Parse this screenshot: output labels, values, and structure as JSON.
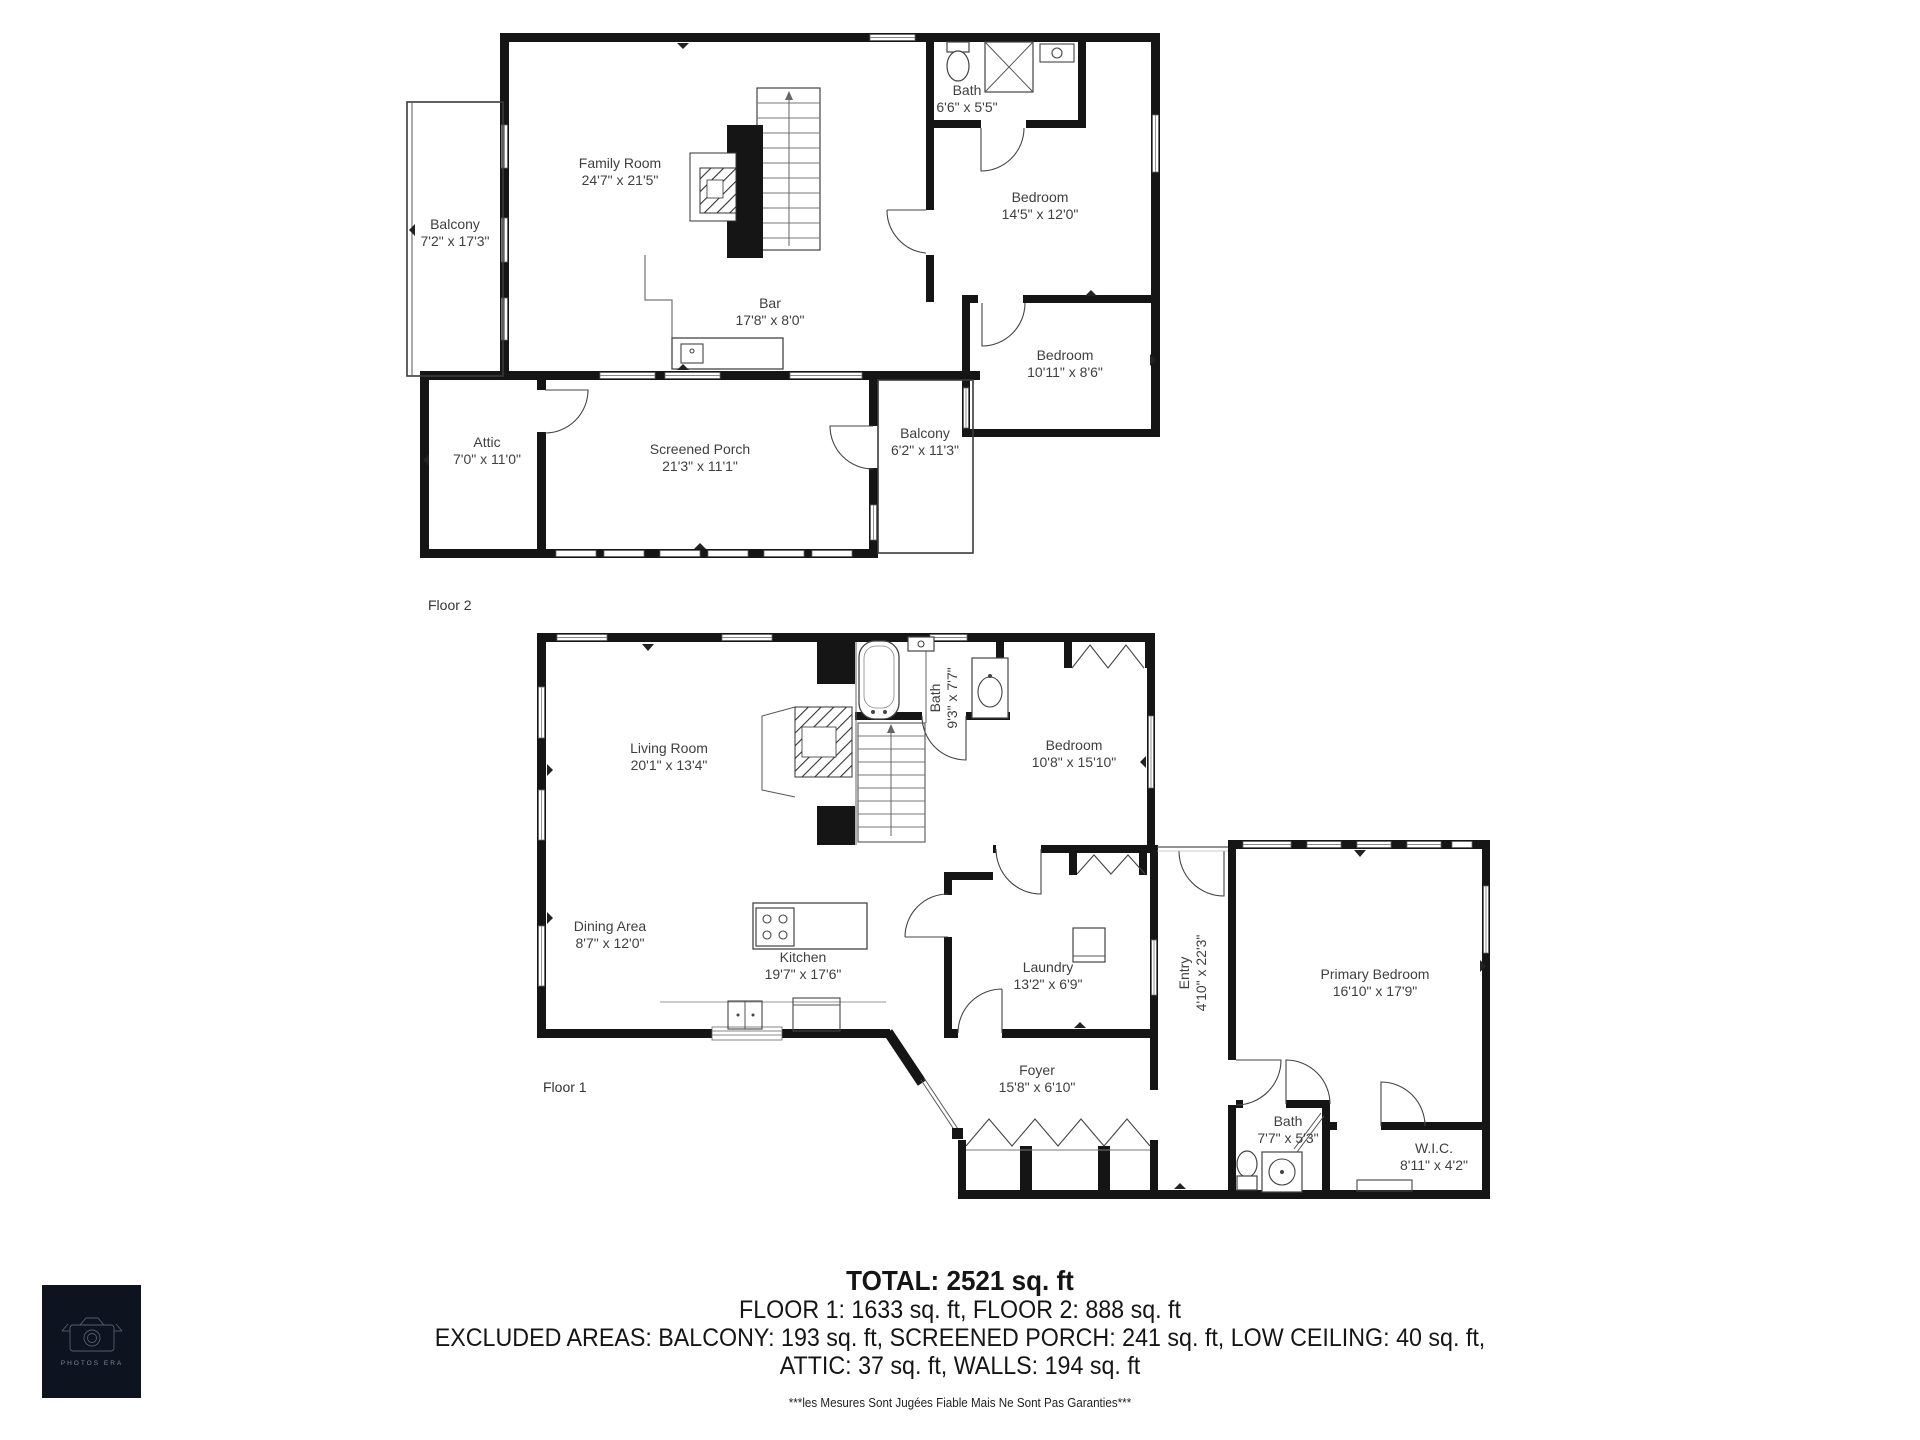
{
  "floor2": {
    "label": "Floor 2",
    "rooms": [
      {
        "id": "family-room",
        "name": "Family Room",
        "dims": "24'7\" x 21'5\""
      },
      {
        "id": "balcony-left",
        "name": "Balcony",
        "dims": "7'2\" x 17'3\""
      },
      {
        "id": "bath",
        "name": "Bath",
        "dims": "6'6\" x 5'5\""
      },
      {
        "id": "bedroom-1",
        "name": "Bedroom",
        "dims": "14'5\" x 12'0\""
      },
      {
        "id": "bar",
        "name": "Bar",
        "dims": "17'8\" x 8'0\""
      },
      {
        "id": "bedroom-2",
        "name": "Bedroom",
        "dims": "10'11\" x 8'6\""
      },
      {
        "id": "attic",
        "name": "Attic",
        "dims": "7'0\" x 11'0\""
      },
      {
        "id": "screened-porch",
        "name": "Screened Porch",
        "dims": "21'3\" x 11'1\""
      },
      {
        "id": "balcony-right",
        "name": "Balcony",
        "dims": "6'2\" x 11'3\""
      }
    ]
  },
  "floor1": {
    "label": "Floor 1",
    "rooms": [
      {
        "id": "living-room",
        "name": "Living Room",
        "dims": "20'1\" x 13'4\""
      },
      {
        "id": "bath-upper",
        "name": "Bath",
        "dims": "9'3\" x 7'7\""
      },
      {
        "id": "bedroom",
        "name": "Bedroom",
        "dims": "10'8\" x 15'10\""
      },
      {
        "id": "dining-area",
        "name": "Dining Area",
        "dims": "8'7\" x 12'0\""
      },
      {
        "id": "kitchen",
        "name": "Kitchen",
        "dims": "19'7\" x 17'6\""
      },
      {
        "id": "laundry",
        "name": "Laundry",
        "dims": "13'2\" x 6'9\""
      },
      {
        "id": "entry",
        "name": "Entry",
        "dims": "4'10\" x 22'3\""
      },
      {
        "id": "primary-bedroom",
        "name": "Primary Bedroom",
        "dims": "16'10\" x 17'9\""
      },
      {
        "id": "foyer",
        "name": "Foyer",
        "dims": "15'8\" x 6'10\""
      },
      {
        "id": "bath-lower",
        "name": "Bath",
        "dims": "7'7\" x 5'3\""
      },
      {
        "id": "wic",
        "name": "W.I.C.",
        "dims": "8'11\" x 4'2\""
      }
    ]
  },
  "summary": {
    "total": "TOTAL: 2521 sq. ft",
    "floors": "FLOOR 1: 1633 sq. ft, FLOOR 2: 888 sq. ft",
    "excluded_1": "EXCLUDED AREAS: BALCONY: 193 sq. ft, SCREENED PORCH: 241 sq. ft, LOW CEILING: 40 sq. ft,",
    "excluded_2": "ATTIC: 37 sq. ft, WALLS: 194 sq. ft",
    "disclaimer": "***les Mesures Sont Jugées Fiable Mais Ne Sont Pas Garanties***"
  },
  "logo": {
    "text": "PHOTOS ERA"
  },
  "colors": {
    "wall": "#151515",
    "label_text": "#3f3f3f",
    "logo_bg": "#0d1420"
  }
}
